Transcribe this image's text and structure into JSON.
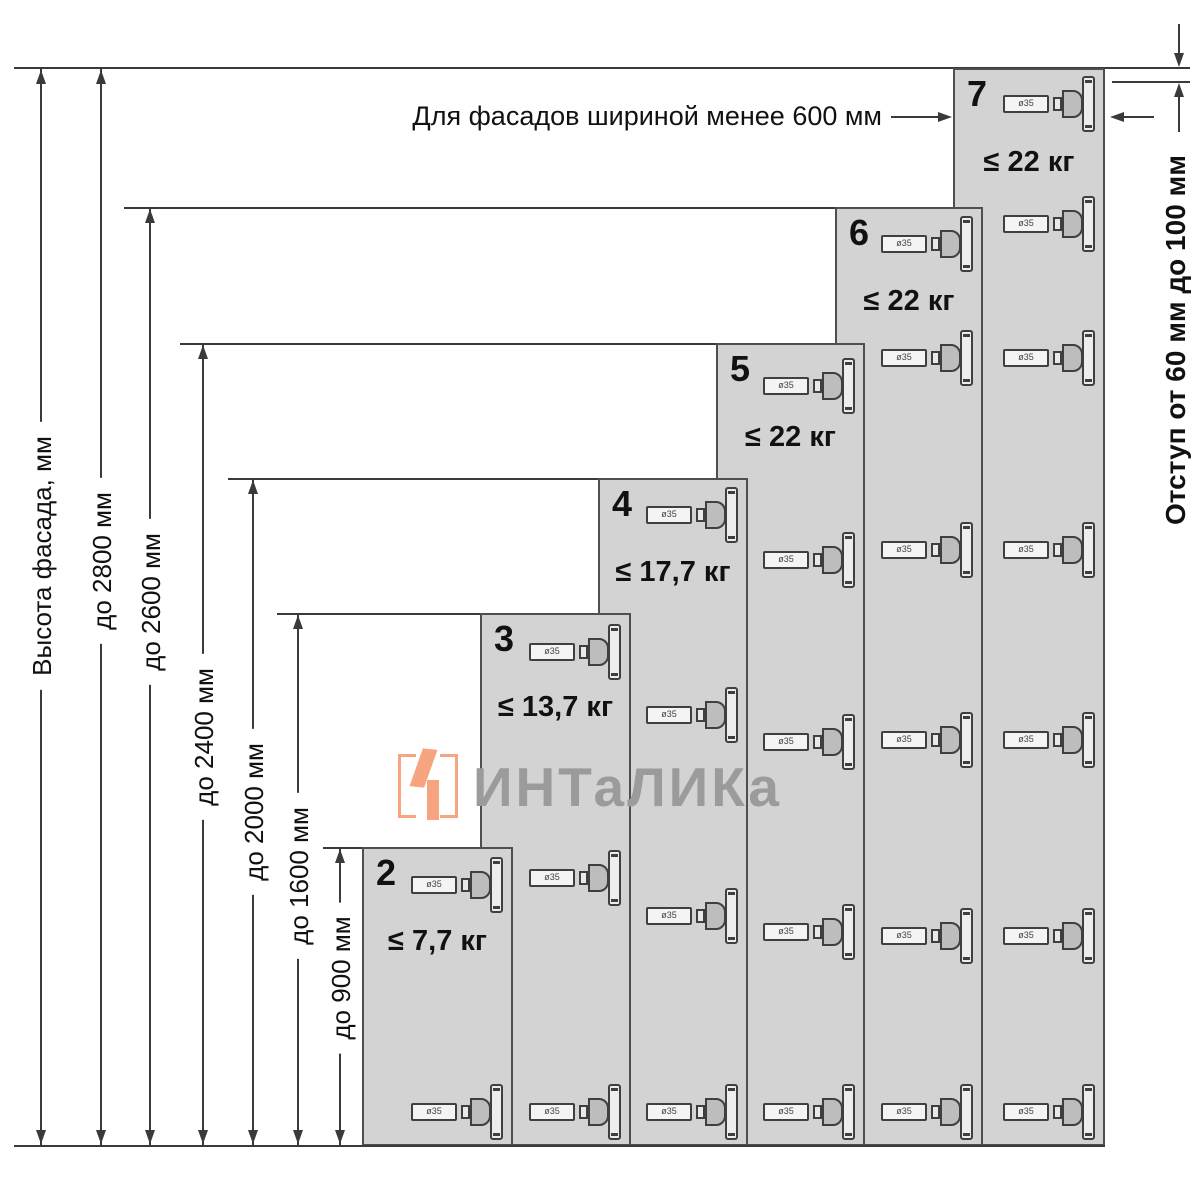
{
  "title_note": "Для фасадов шириной менее 600 мм",
  "right_note": "Отступ от 60 мм до 100 мм",
  "axis": {
    "label": "Высота фасада, мм"
  },
  "dimensions": [
    {
      "label": "Высота фасада, мм",
      "kind": "axis"
    },
    {
      "label": "до 2800 мм",
      "kind": "height-limit"
    },
    {
      "label": "до 2600 мм",
      "kind": "height-limit"
    },
    {
      "label": "до 2400 мм",
      "kind": "height-limit"
    },
    {
      "label": "до 2000 мм",
      "kind": "height-limit"
    },
    {
      "label": "до 1600 мм",
      "kind": "height-limit"
    },
    {
      "label": "до 900 мм",
      "kind": "height-limit"
    }
  ],
  "columns": [
    {
      "number": "2",
      "max_weight": "≤ 7,7 кг",
      "height_label": "до 900 мм",
      "hinge_count": 2,
      "hinges_y": [
        885,
        1112
      ]
    },
    {
      "number": "3",
      "max_weight": "≤ 13,7 кг",
      "height_label": "до 1600 мм",
      "hinge_count": 3,
      "hinges_y": [
        652,
        878,
        1112
      ]
    },
    {
      "number": "4",
      "max_weight": "≤ 17,7 кг",
      "height_label": "до 2000 мм",
      "hinge_count": 4,
      "hinges_y": [
        515,
        715,
        916,
        1112
      ]
    },
    {
      "number": "5",
      "max_weight": "≤ 22 кг",
      "height_label": "до 2400 мм",
      "hinge_count": 5,
      "hinges_y": [
        386,
        560,
        742,
        932,
        1112
      ]
    },
    {
      "number": "6",
      "max_weight": "≤ 22 кг",
      "height_label": "до 2600 мм",
      "hinge_count": 6,
      "hinges_y": [
        244,
        358,
        550,
        740,
        936,
        1112
      ]
    },
    {
      "number": "7",
      "max_weight": "≤ 22 кг",
      "height_label": "до 2800 мм",
      "hinge_count": 7,
      "hinges_y": [
        104,
        224,
        358,
        550,
        740,
        936,
        1112
      ]
    }
  ],
  "hinge_marking": "ø35",
  "watermark": {
    "text": "ИНТаЛИКа"
  },
  "colors": {
    "column_fill": "#d3d3d3",
    "column_border": "#4f4f4f",
    "line": "#3a3a3a",
    "text": "#111111",
    "watermark_orange": "#F7A480",
    "watermark_gray": "#9B9B9B"
  }
}
